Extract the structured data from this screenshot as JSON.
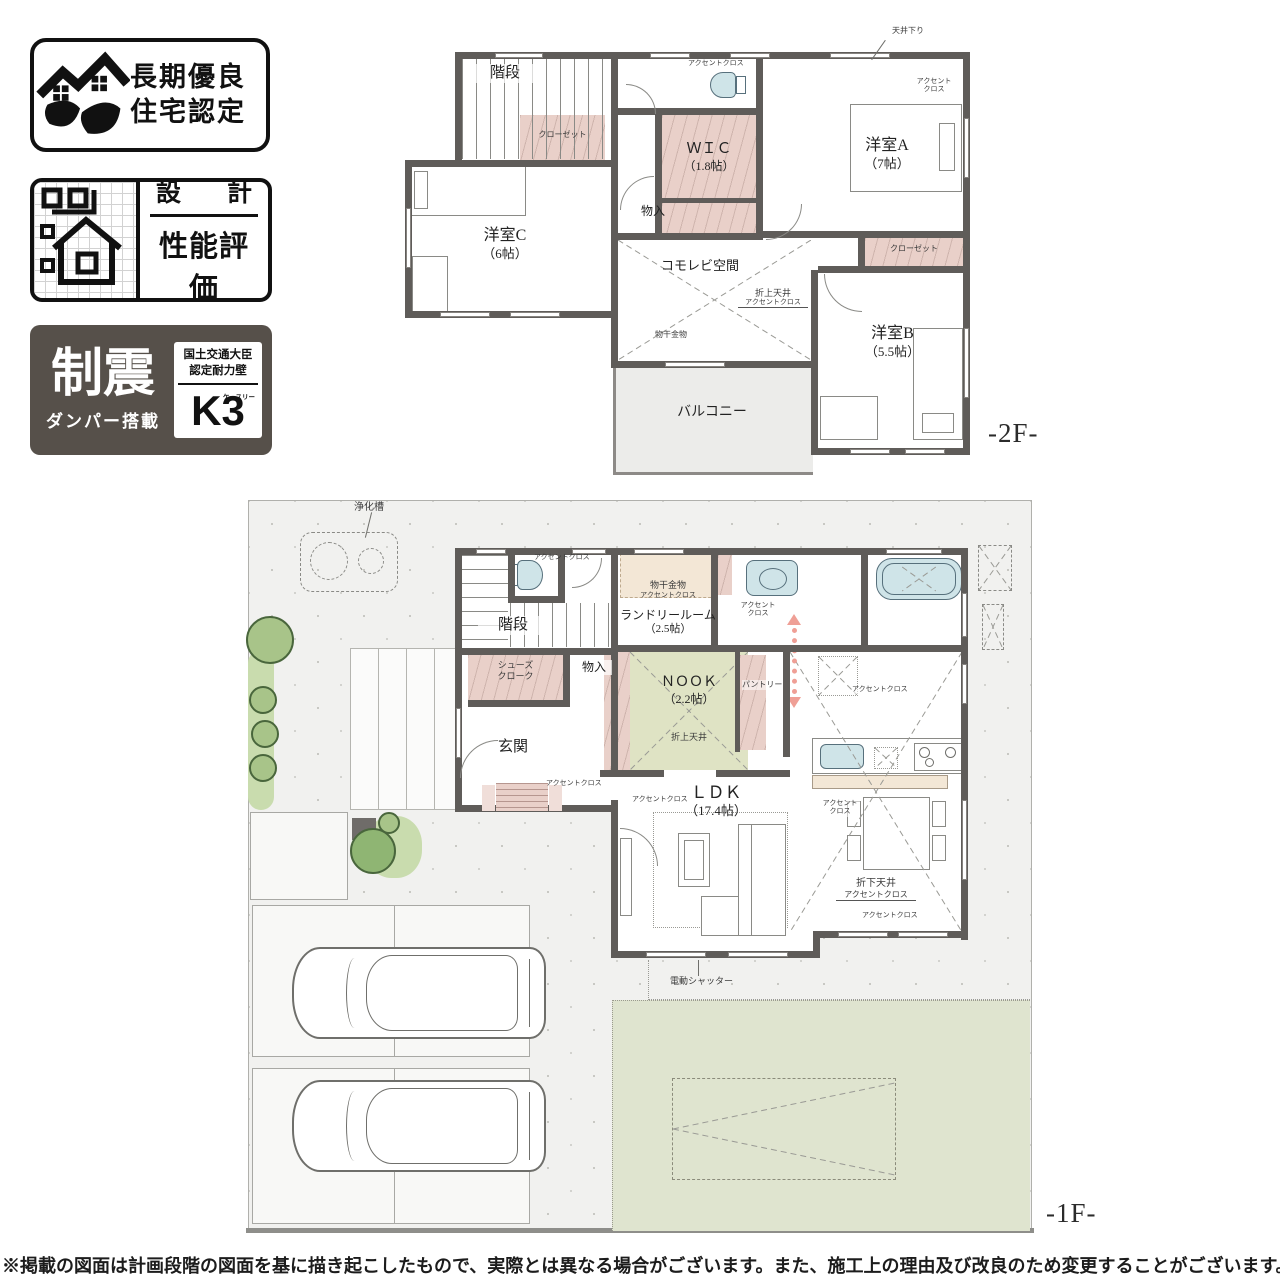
{
  "colors": {
    "wall": "#5f5c59",
    "closet_pink": "#e9d0c9",
    "nook_green": "#dfe3c4",
    "laundry_beige": "#f3e7d6",
    "fixture_blue": "#cfe4e8",
    "balcony_gray": "#ececea",
    "ground": "#f1f1ef",
    "lawn": "#dfe4cf",
    "tree_green": "#a8c489",
    "flow_arrow_pink": "#ef9f96",
    "badge_dark": "#56504a"
  },
  "badges": {
    "longterm": {
      "line1": "長期優良",
      "line2": "住宅認定"
    },
    "design": {
      "top_left": "設",
      "top_right": "計",
      "bottom": "性能評価"
    },
    "seismic": {
      "title": "制震",
      "subtitle": "ダンパー搭載",
      "cert_line1": "国土交通大臣",
      "cert_line2": "認定耐力壁",
      "mark": "K3",
      "mark_kana": "ケースリー"
    }
  },
  "floor2": {
    "floor_label": "-2F-",
    "stairs": "階段",
    "closet_left": "クローゼット",
    "toilet_accent": "アクセントクロス",
    "wic_name": "ＷＩＣ",
    "wic_size": "（1.8帖）",
    "storage": "物入",
    "ceiling_down": "天井下り",
    "room_a_name": "洋室A",
    "room_a_size": "（7帖）",
    "room_a_accent1": "アクセント",
    "room_a_accent2": "クロス",
    "room_c_name": "洋室C",
    "room_c_size": "（6帖）",
    "komorebi": "コモレビ空間",
    "coved1": "折上天井",
    "coved2": "アクセントクロス",
    "laundry_bar": "物干金物",
    "closet_b": "クローゼット",
    "room_b_name": "洋室B",
    "room_b_size": "（5.5帖）",
    "balcony": "バルコニー"
  },
  "floor1": {
    "floor_label": "-1F-",
    "septic": "浄化槽",
    "stairs": "階段",
    "toilet_accent": "アクセントクロス",
    "laundry_bar": "物干金物",
    "laundry_accent": "アクセントクロス",
    "laundry_name": "ランドリールーム",
    "laundry_size": "（2.5帖）",
    "wash_accent1": "アクセント",
    "wash_accent2": "クロス",
    "shoes1": "シューズ",
    "shoes2": "クローク",
    "storage": "物入",
    "nook_name": "ＮＯＯＫ",
    "nook_size": "（2.2帖）",
    "pantry": "パントリー",
    "nook_coved": "折上天井",
    "entrance": "玄関",
    "hall_accent": "アクセントクロス",
    "fridge_accent": "アクセントクロス",
    "ldk_name": "ＬＤＫ",
    "ldk_size": "（17.4帖）",
    "ldk_accent_left": "アクセントクロス",
    "dining_accent1": "アクセント",
    "dining_accent2": "クロス",
    "dropped1": "折下天井",
    "dropped2": "アクセントクロス",
    "ldk_accent_bottom": "アクセントクロス",
    "shutter": "電動シャッター"
  },
  "disclaimer": "※掲載の図面は計画段階の図面を基に描き起こしたもので、実際とは異なる場合がございます。また、施工上の理由及び改良のため変更することがございます。"
}
